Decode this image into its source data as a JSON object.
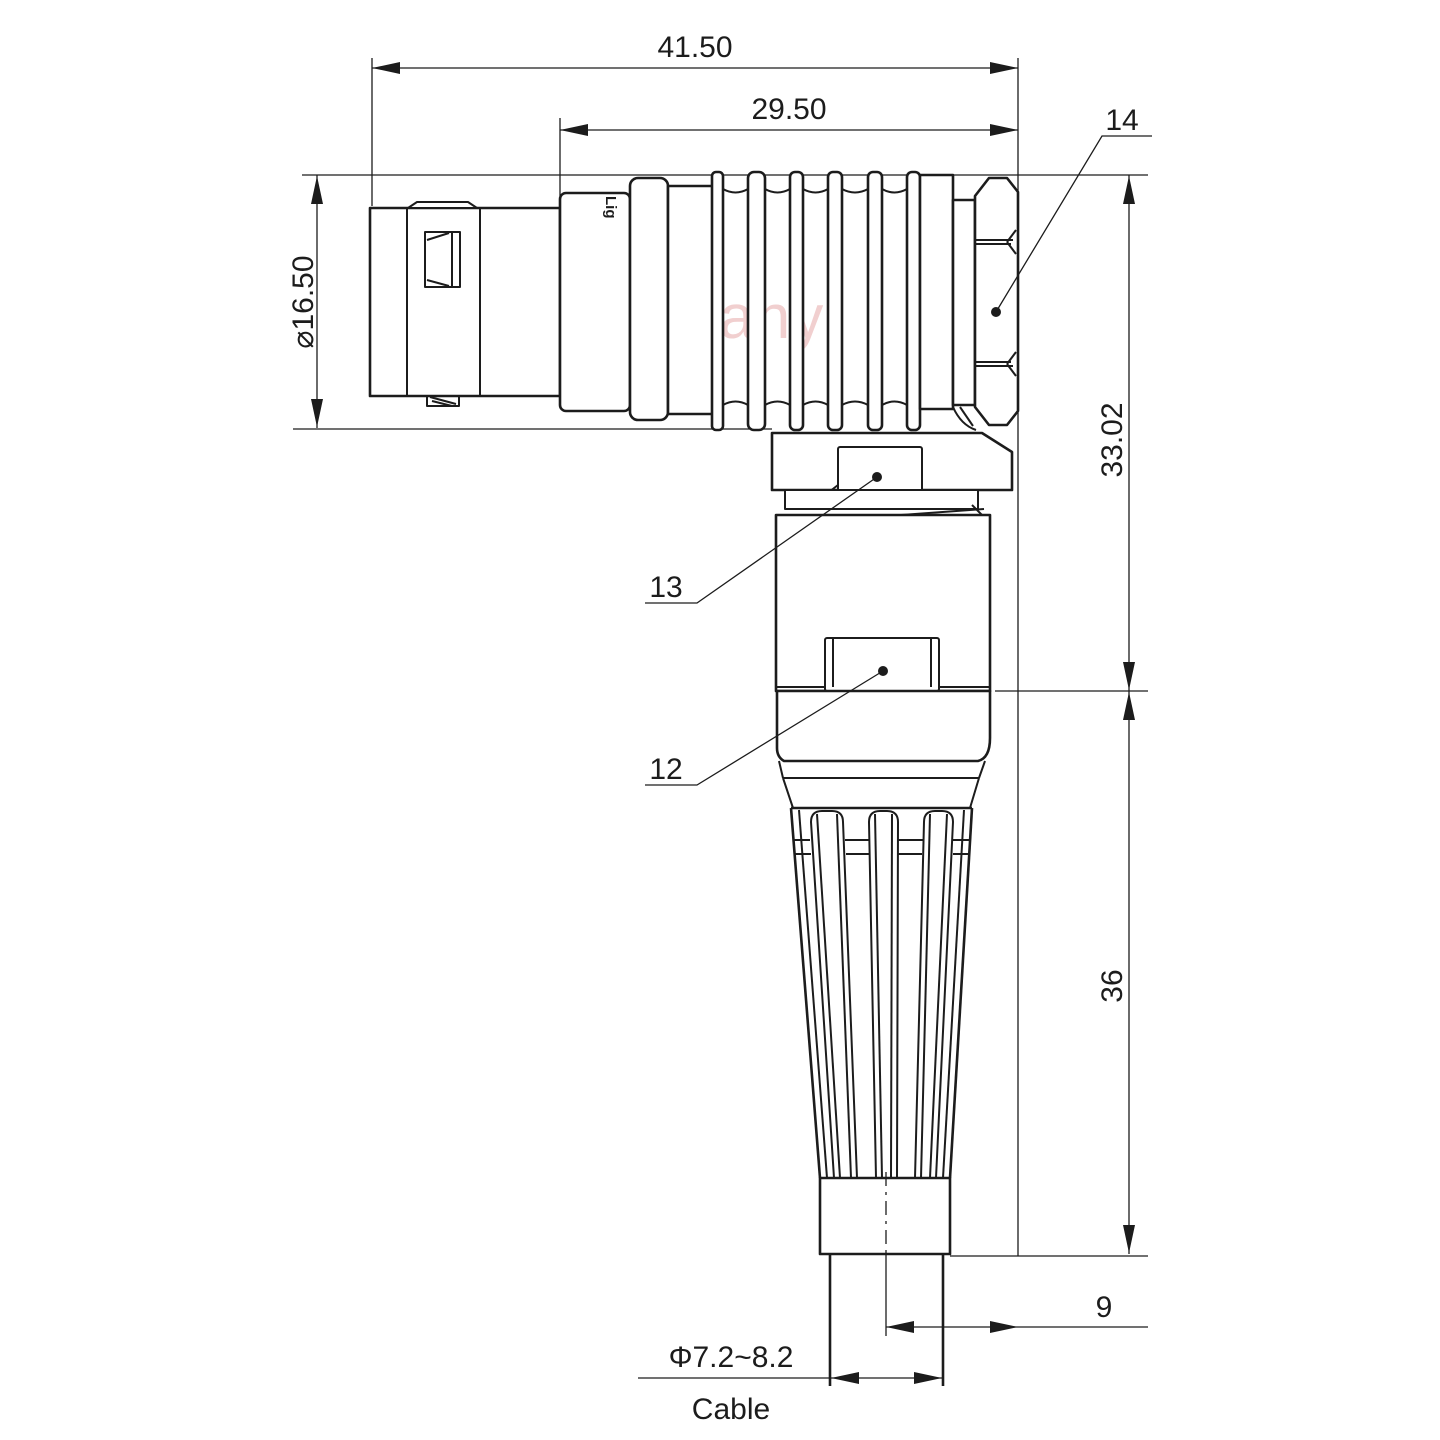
{
  "page": {
    "background": "#ffffff",
    "line_color": "#1c1c1c"
  },
  "watermark": {
    "text": "Lightany",
    "color": "#f1cfcf"
  },
  "connector": {
    "brand_stamp": "Lig"
  },
  "dimensions": {
    "overall_length": "41.50",
    "rear_length": "29.50",
    "front_diameter": "⌀16.50",
    "upper_height": "33.02",
    "lower_height": "36",
    "axis_offset": "9",
    "cable_diameter": "Φ7.2~8.2",
    "cable_caption": "Cable"
  },
  "part_labels": {
    "nut": "14",
    "release_sleeve": "13",
    "body": "12"
  }
}
